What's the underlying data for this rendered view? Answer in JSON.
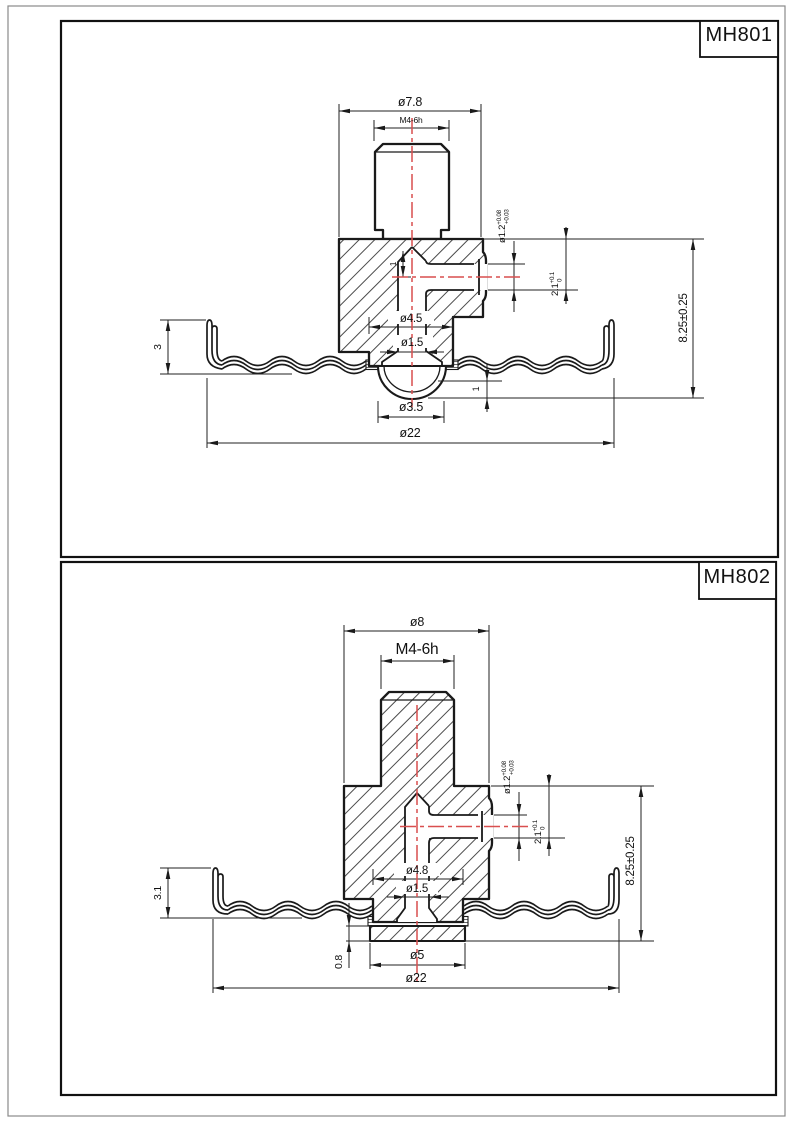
{
  "page": {
    "background": "#ffffff",
    "line_color": "#1a1a1a",
    "centerline_color": "#d94f4f"
  },
  "panels": [
    {
      "label": "MH801",
      "dims": {
        "top_od": "ø7.8",
        "thread": "M4-6h",
        "tip_height": "1",
        "port_dia": "ø1.2",
        "port_dia_up": "+0.08",
        "port_dia_dn": "+0.03",
        "port_depth": "2.1",
        "port_depth_up": "+0.1",
        "port_depth_dn": "0",
        "height": "8.25±0.25",
        "bore": "ø4.5",
        "channel": "ø1.5",
        "rim_height": "3",
        "dome_height": "1",
        "dome_dia": "ø3.5",
        "disc_dia": "ø22"
      }
    },
    {
      "label": "MH802",
      "dims": {
        "top_od": "ø8",
        "thread": "M4-6h",
        "port_dia": "ø1.2",
        "port_dia_up": "+0.08",
        "port_dia_dn": "+0.03",
        "port_depth": "2.1",
        "port_depth_up": "+0.1",
        "port_depth_dn": "0",
        "height": "8.25±0.25",
        "bore": "ø4.8",
        "channel": "ø1.5",
        "rim_height": "3.1",
        "flange_thickness": "0.8",
        "flange_dia": "ø5",
        "disc_dia": "ø22"
      }
    }
  ]
}
